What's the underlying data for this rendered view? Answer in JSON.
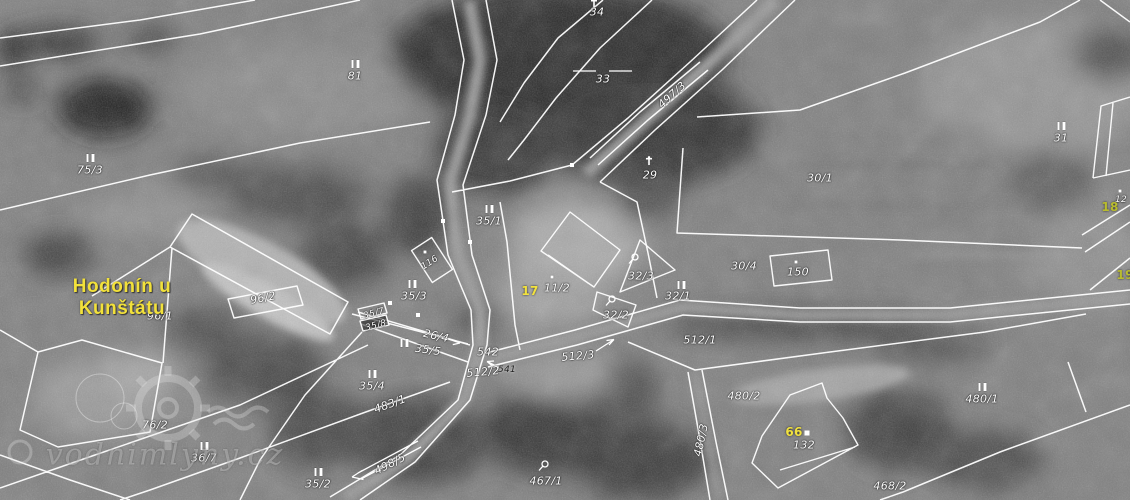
{
  "place": {
    "line1": "Hodonín u",
    "line2": "Kunštátu"
  },
  "watermark": {
    "text": "vodnimlyny.cz"
  },
  "colors": {
    "parcel_label": "#ffffff",
    "place_name": "#f2e13b",
    "house_number": "#f2e23e",
    "evidence_number": "#b9bc2e",
    "boundary_line": "#ffffff"
  },
  "map": {
    "labels": [
      {
        "t": "34",
        "x": 597,
        "y": 12
      },
      {
        "t": "81",
        "x": 355,
        "y": 76
      },
      {
        "t": "33",
        "x": 603,
        "y": 79
      },
      {
        "t": "497/3",
        "x": 672,
        "y": 95,
        "r": -42
      },
      {
        "t": "75/3",
        "x": 90,
        "y": 170
      },
      {
        "t": "29",
        "x": 650,
        "y": 175
      },
      {
        "t": "30/1",
        "x": 820,
        "y": 178
      },
      {
        "t": "31",
        "x": 1061,
        "y": 138
      },
      {
        "t": "35/1",
        "x": 489,
        "y": 221
      },
      {
        "t": "116",
        "x": 430,
        "y": 263,
        "k": "small",
        "r": -33
      },
      {
        "t": "35/3",
        "x": 414,
        "y": 296
      },
      {
        "t": "11/2",
        "x": 557,
        "y": 288
      },
      {
        "t": "17",
        "x": 530,
        "y": 291,
        "k": "house"
      },
      {
        "t": "32/3",
        "x": 641,
        "y": 276
      },
      {
        "t": "32/1",
        "x": 678,
        "y": 296
      },
      {
        "t": "32/2",
        "x": 616,
        "y": 315
      },
      {
        "t": "30/4",
        "x": 744,
        "y": 266
      },
      {
        "t": "150",
        "x": 798,
        "y": 272
      },
      {
        "t": "512/1",
        "x": 700,
        "y": 340
      },
      {
        "t": "96/2",
        "x": 263,
        "y": 298,
        "r": -11
      },
      {
        "t": "96/1",
        "x": 160,
        "y": 316
      },
      {
        "t": "35/7",
        "x": 374,
        "y": 314,
        "k": "small",
        "r": -15
      },
      {
        "t": "35/8",
        "x": 376,
        "y": 326,
        "k": "small",
        "r": -15
      },
      {
        "t": "26/4",
        "x": 436,
        "y": 336,
        "r": 13
      },
      {
        "t": "35/5",
        "x": 428,
        "y": 350,
        "r": 8
      },
      {
        "t": "542",
        "x": 488,
        "y": 352
      },
      {
        "t": "512/3",
        "x": 578,
        "y": 356,
        "r": -5
      },
      {
        "t": "512/2",
        "x": 483,
        "y": 372,
        "r": -5
      },
      {
        "t": "541",
        "x": 507,
        "y": 370,
        "k": "darknum"
      },
      {
        "t": "35/4",
        "x": 372,
        "y": 386
      },
      {
        "t": "483/1",
        "x": 390,
        "y": 404,
        "r": -20
      },
      {
        "t": "76/2",
        "x": 155,
        "y": 425
      },
      {
        "t": "36/7",
        "x": 204,
        "y": 458
      },
      {
        "t": "35/2",
        "x": 318,
        "y": 484
      },
      {
        "t": "498/5",
        "x": 390,
        "y": 464,
        "r": -27
      },
      {
        "t": "467/1",
        "x": 546,
        "y": 481
      },
      {
        "t": "480/2",
        "x": 744,
        "y": 396
      },
      {
        "t": "480/3",
        "x": 701,
        "y": 440,
        "r": -78
      },
      {
        "t": "66",
        "x": 794,
        "y": 432,
        "k": "house"
      },
      {
        "t": "132",
        "x": 804,
        "y": 445
      },
      {
        "t": "468/2",
        "x": 890,
        "y": 486
      },
      {
        "t": "480/1",
        "x": 982,
        "y": 399
      },
      {
        "t": "12",
        "x": 1121,
        "y": 200,
        "k": "small"
      },
      {
        "t": "18",
        "x": 1110,
        "y": 207,
        "k": "evidence"
      },
      {
        "t": "19",
        "x": 1125,
        "y": 275,
        "k": "evidence"
      }
    ],
    "symbols": [
      {
        "k": "pair",
        "x": 355,
        "y": 64
      },
      {
        "k": "pair",
        "x": 90,
        "y": 158
      },
      {
        "k": "pair",
        "x": 489,
        "y": 209
      },
      {
        "k": "pair",
        "x": 1061,
        "y": 126
      },
      {
        "k": "pair",
        "x": 412,
        "y": 284
      },
      {
        "k": "pair",
        "x": 681,
        "y": 285
      },
      {
        "k": "pair",
        "x": 404,
        "y": 343
      },
      {
        "k": "pair",
        "x": 372,
        "y": 374
      },
      {
        "k": "pair",
        "x": 204,
        "y": 446
      },
      {
        "k": "pair",
        "x": 318,
        "y": 472
      },
      {
        "k": "pair",
        "x": 982,
        "y": 387
      },
      {
        "k": "tree",
        "x": 634,
        "y": 259
      },
      {
        "k": "tree",
        "x": 611,
        "y": 301
      },
      {
        "k": "tree",
        "x": 544,
        "y": 466
      },
      {
        "k": "dot",
        "x": 425,
        "y": 252
      },
      {
        "k": "dot",
        "x": 552,
        "y": 277
      },
      {
        "k": "dot",
        "x": 796,
        "y": 262
      },
      {
        "k": "dot",
        "x": 1120,
        "y": 191
      },
      {
        "k": "sqdot",
        "x": 807,
        "y": 433
      },
      {
        "k": "mark",
        "x": 594,
        "y": 3
      },
      {
        "k": "mark",
        "x": 649,
        "y": 161
      }
    ]
  }
}
